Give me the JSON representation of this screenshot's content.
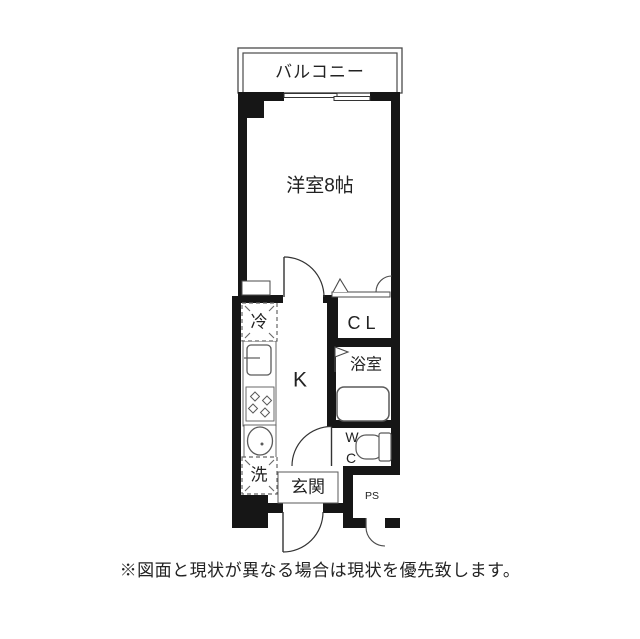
{
  "floorplan": {
    "balcony_label": "バルコニー",
    "main_room_label": "洋室8帖",
    "kitchen_label": "K",
    "closet_label": "CL",
    "bath_label": "浴室",
    "wc_label_top": "W",
    "wc_label_bottom": "C",
    "refrigerator_label": "冷",
    "washer_label": "洗",
    "entrance_label": "玄関",
    "pipe_shaft_label": "PS"
  },
  "note_text": "※図面と現状が異なる場合は現状を優先致します。",
  "colors": {
    "wall": "#161616",
    "thin_line": "#4a4a4a",
    "fixture_line": "#5a5a5a",
    "text": "#222222",
    "background": "#ffffff"
  }
}
